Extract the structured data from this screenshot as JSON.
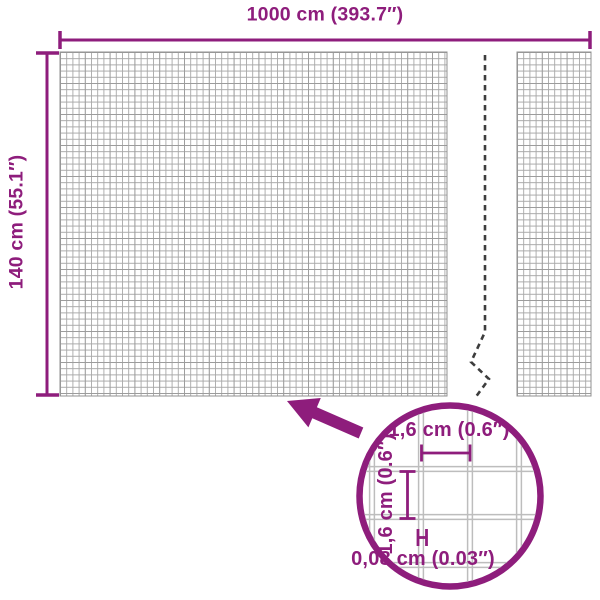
{
  "dimensions": {
    "width_label": "1000 cm (393.7″)",
    "height_label": "140 cm (55.1″)"
  },
  "detail_view": {
    "cell_width_label": "1,6 cm (0.6″)",
    "cell_height_label": "1,6 cm (0.6″)",
    "wire_thickness_label": "0,08 cm (0.03″)"
  },
  "colors": {
    "accent": "#8E1D7C",
    "mesh_line": "#a8a8a8",
    "mesh_line_dark": "#8f8f8f",
    "mesh_border": "#909090",
    "detail_grid": "#bdbdbd",
    "tear_line": "#3d3d3d",
    "background": "#ffffff"
  }
}
